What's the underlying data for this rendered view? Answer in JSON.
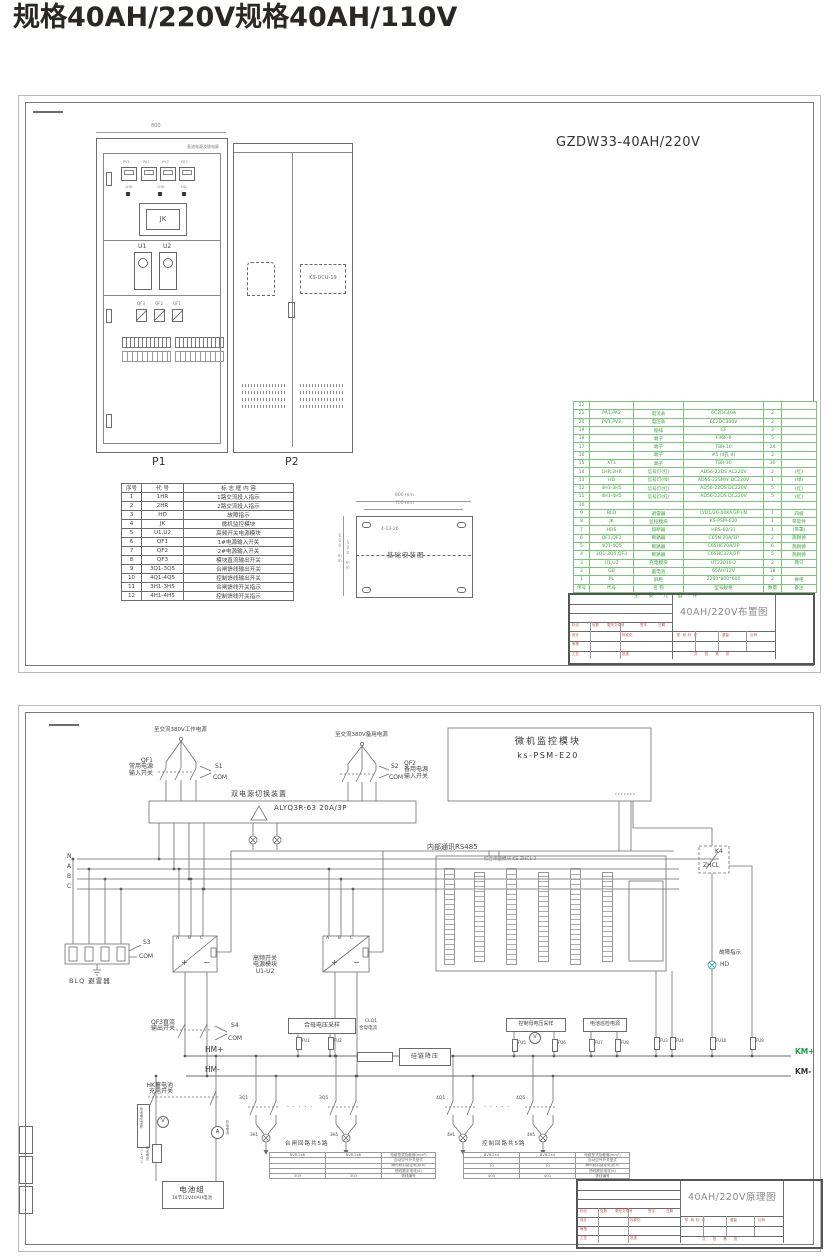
{
  "page_title": "规格40AH/220V规格40AH/110V",
  "sheet1": {
    "model_title": "GZDW33-40AH/220V",
    "cabinet_top_label": "直流电源及馈电屏",
    "dim_800": "800",
    "p1_label": "P1",
    "p2_label": "P2",
    "p1": {
      "jk": "JK",
      "u1": "U1",
      "u2": "U2",
      "meters": [
        "PV1",
        "PA1",
        "PV2",
        "PA2"
      ],
      "lamps": [
        "1HR",
        "2HR",
        "HD"
      ],
      "qf": [
        "QF3",
        "QF2",
        "QF1"
      ]
    },
    "p2": {
      "dcu": "KS-DCU-19"
    },
    "legend": {
      "rows": [
        [
          "序号",
          "代  号",
          "标 志 框 内 容"
        ],
        [
          "1",
          "1HR",
          "1路交流投入指示"
        ],
        [
          "2",
          "2HR",
          "2路交流投入指示"
        ],
        [
          "3",
          "HD",
          "故障指示"
        ],
        [
          "4",
          "JK",
          "微机监控模块"
        ],
        [
          "5",
          "U1,U2",
          "高频开关电源模块"
        ],
        [
          "6",
          "QF1",
          "1#电源输入开关"
        ],
        [
          "7",
          "QF2",
          "2#电源输入开关"
        ],
        [
          "8",
          "QF3",
          "模块直流输出开关"
        ],
        [
          "9",
          "3Q1-3Q5",
          "合闸馈线输出开关"
        ],
        [
          "10",
          "4Q1-4Q5",
          "控制馈线输出开关"
        ],
        [
          "11",
          "3H1-3H5",
          "合闸馈线开关指示"
        ],
        [
          "12",
          "4H1-4H5",
          "控制馈线开关指示"
        ]
      ]
    },
    "foundation": {
      "title": "基础安装图",
      "dim1": "800 mm",
      "dim2": "700 mm",
      "dim3": "600 mm",
      "dim4": "500 mm",
      "note": "4-13-20"
    },
    "parts": {
      "rows": [
        [
          "22",
          "",
          "",
          "",
          "",
          ""
        ],
        [
          "21",
          "PA1,PA2",
          "电流表",
          "6C2DC40A",
          "2",
          ""
        ],
        [
          "20",
          "PV1,PV2",
          "电压表",
          "6C2DC300V",
          "2",
          ""
        ],
        [
          "19",
          "",
          "铜排",
          "CF",
          "3",
          ""
        ],
        [
          "18",
          "",
          "端子",
          "F36E-6",
          "5",
          ""
        ],
        [
          "17",
          "",
          "端子",
          "T8R-10",
          "24",
          ""
        ],
        [
          "16",
          "",
          "端子",
          "#5 (4孔-4)",
          "2",
          ""
        ],
        [
          "15",
          "XT1",
          "端子",
          "T8R-30",
          "30",
          ""
        ],
        [
          "14",
          "1HR,2HR",
          "信号灯(红)",
          "AD56-22DS AC220V",
          "2",
          "(红)"
        ],
        [
          "13",
          "HD",
          "信号灯(绿)",
          "AD56-22SM/Y DC220V",
          "1",
          "(绿)"
        ],
        [
          "12",
          "3H1-3H5",
          "信号灯(红)",
          "AD56-22DS DC220V",
          "5",
          "(红)"
        ],
        [
          "11",
          "4H1-4H5",
          "信号灯(红)",
          "AD56-22DS DC220V",
          "5",
          "(红)"
        ],
        [
          "10",
          "",
          "",
          "",
          "",
          ""
        ],
        [
          "9",
          "BLQ",
          "避雷器",
          "LYD1/20-40KA/3P+N",
          "1",
          "四极"
        ],
        [
          "8",
          "JK",
          "监控模块",
          "KS-PSM-E20",
          "1",
          "带软件"
        ],
        [
          "7",
          "HRS",
          "熔断器",
          "HRS-60/31",
          "1",
          "(带罩)"
        ],
        [
          "6",
          "QF1,QF2",
          "断路器",
          "C65N 20A/3P",
          "2",
          "施耐德"
        ],
        [
          "5",
          "4Q1-4Q5",
          "断路器",
          "C65HC20A/2P",
          "6",
          "施耐德"
        ],
        [
          "4",
          "3Q1-3Q5,QF3",
          "断路器",
          "C65HC32A/2P",
          "5",
          "施耐德"
        ],
        [
          "3",
          "U1,U2",
          "充电模块",
          "UT22010-2",
          "2",
          "两只"
        ],
        [
          "2",
          "GB",
          "蓄电池",
          "65AH/12V",
          "18",
          ""
        ],
        [
          "1",
          "PL",
          "屏柜",
          "2260*800*600",
          "2",
          "拼柜"
        ],
        [
          "序号",
          "代号",
          "名 称",
          "型号规格",
          "数量",
          "备注"
        ]
      ],
      "footer": "主 要 元 器 件"
    }
  },
  "titleblock": {
    "mark": "标记",
    "count": "处数",
    "file": "更改文件号",
    "sign": "签字",
    "date": "日期",
    "design": "设计",
    "check": "审核",
    "craft": "工艺",
    "approve": "批准",
    "std": "标准化",
    "stage": "阶段标记",
    "weight": "重量",
    "scale": "比例",
    "sheets": "共 张 第 张"
  },
  "tb1_title": "40AH/220V布置图",
  "tb2_title": "40AH/220V原理图",
  "s2": {
    "src1": "至交流380V工作电源",
    "src2": "至交流380V备用电源",
    "qf1a": "QF1",
    "qf1b": "常用电源",
    "qf1c": "输入开关",
    "qf2a": "QF2",
    "qf2b": "备用电源",
    "qf2c": "输入开关",
    "s1": "S1",
    "s2": "S2",
    "s3": "S3",
    "s4": "S4",
    "com": "COM",
    "ats_t": "双电源切换装置",
    "ats_m": "ALYQ3R-63 20A/3P",
    "psm_t": "微机监控模块",
    "psm_m": "ks-PSM-E20",
    "rs485": "内部通讯RS485",
    "zhcl_t": "综合测量模块 KS-ZHCL-2",
    "n": "N",
    "a": "A",
    "b": "B",
    "c": "C",
    "blq": "BLQ 避雷器",
    "rect1": "高频开关",
    "rect2": "电源模块",
    "rect3": "U1-U2",
    "plus": "+",
    "minus": "−",
    "k4": "K4",
    "zhcl": "ZHCL",
    "fault": "故障指示",
    "hd": "HD",
    "qf3a": "QF3直流",
    "qf3b": "输出开关",
    "hmp": "HM+",
    "hmm": "HM-",
    "kmp": "KM+",
    "kmm": "KM-",
    "hemu": "合母电压采样",
    "kmu": "控制母电压采样",
    "batins": "电池巡检电源",
    "fu1": "FU1",
    "fu2": "FU2",
    "fu3": "FU3",
    "fu4": "FU4",
    "fu5": "FU5",
    "fu6": "FU6",
    "fu7": "FU7",
    "fu8": "FU8",
    "fu9": "FU9",
    "fu10": "FU10",
    "clq1": "CLQ1",
    "clq1b": "合母电流",
    "gui": "硅链降压",
    "hka": "HK蓄电池",
    "hkb": "充电开关",
    "bvs": "电池电压采样",
    "clq2": "CLQ2",
    "clq2b": "电池电流",
    "chga": "充电电流",
    "amp": "A",
    "volt": "V",
    "bat1": "电池组",
    "bat2": "18节12V40AH电池",
    "cl_t": "合闸回路共5路",
    "ct_t": "控制回路共5路",
    "q31": "3Q1",
    "q35": "3Q5",
    "h31": "3H1",
    "h35": "3H5",
    "q41": "4Q1",
    "q45": "4Q5",
    "h41": "4H1",
    "h45": "4H5",
    "dots": "· · · · ·",
    "closing_table": {
      "rows": [
        [
          "BVR-2x6",
          "BVR-2x6",
          "电缆型式及截面(mm²)"
        ],
        [
          "",
          "",
          "自动空气开关型式"
        ],
        [
          "",
          "",
          "瞬时脱扣整定电流(A)"
        ],
        [
          "",
          "",
          "馈线额定电流(A)"
        ],
        [
          "3Q5",
          "3Q1",
          "馈线编号"
        ]
      ]
    },
    "control_table": {
      "rows": [
        [
          "BVR-2x4",
          "BVR-2x4",
          "电缆型式及截面(mm²)"
        ],
        [
          "",
          "",
          "自动空气开关型式"
        ],
        [
          "20",
          "20",
          "瞬时脱扣整定电流(A)"
        ],
        [
          "",
          "",
          "馈线额定电流(A)"
        ],
        [
          "4Q5",
          "4Q1",
          "馈线编号"
        ]
      ]
    }
  }
}
